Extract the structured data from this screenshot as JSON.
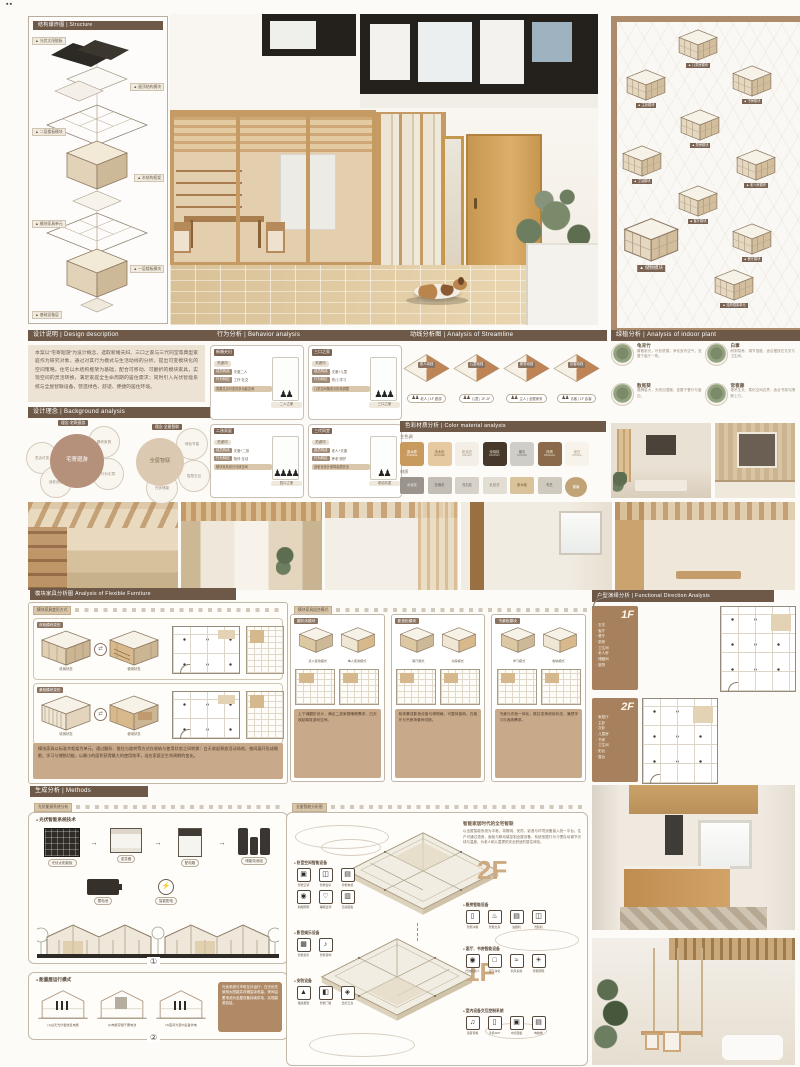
{
  "meta": {
    "corner_marks": "▪▪"
  },
  "headers": {
    "structure": "结构爆炸图 | Structure",
    "design": "设计说明 | Design description",
    "concept": "设计理念 | Background analysis",
    "behavior": "行为分析 | Behavior analysis",
    "circulation": "动线分析图 | Analysis of Streamline",
    "colors": "色彩材质分析 | Color material analysis",
    "plants": "绿植分析 | Analysis of indoor plant",
    "furniture": "模块家具分析图 Analysis of Flexible Furniture",
    "plans": "户型演绎分析 | Functional Direction Analysis",
    "methods": "生成分析 | Methods"
  },
  "structure": {
    "tags": [
      "▲ 光伏太阳能板",
      "▲ 屋顶结构模块",
      "▲ 二层楼板模块",
      "▲ 木结构框架",
      "▲ 模块家具单元",
      "▲ 一层楼板模块",
      "▲ 基础设备层"
    ]
  },
  "modules": {
    "tags": [
      "▲ 儿童房模块",
      "▲ 书房模块",
      "▲ 主卧模块",
      "▲ 厨房模块",
      "▲ 卫浴模块",
      "▲ 老人房模块",
      "▲ 客厅模块",
      "▲ 餐厅模块",
      "▲ 储物模块",
      "▲ 结构框架单元"
    ]
  },
  "design": {
    "body": "本案以“宅寄廻游”为设计概念，选取新婚夫妇、三口之家与三代同堂等典型家庭作为研究对象，通过对其行为模式与生活动线的分析，提出可变模块化的空间策略。住宅以木结构框架为基础，配合可移动、可翻折的模块家具，实现空间的灵活转换，满足家庭全生命周期的居住需求；同时引入光伏智能系统与全屋智联设备，营造绿色、舒适、便捷的居住环境。"
  },
  "concept": {
    "v1": {
      "tag": "理念·宅寄廻游",
      "center": "宅寄廻游",
      "s": [
        "灵活可变",
        "适老适幼",
        "模块家具",
        "行为引导"
      ]
    },
    "v2": {
      "tag": "理念·全屋智联",
      "center": "全屋智联",
      "s": [
        "绿色节能",
        "智慧交互",
        "光伏储能"
      ]
    }
  },
  "behavior": {
    "cards": [
      {
        "tag": "新婚夫妇",
        "kw": "关键词",
        "k1": "成员构成",
        "v1": "夫妻二人",
        "k2": "行为特征",
        "v2": "工作·社交",
        "note": "需要灵活可变的多功能空间",
        "figs": "♟♟",
        "cap": "二人之家"
      },
      {
        "tag": "三口之家",
        "kw": "关键词",
        "k1": "成员构成",
        "v1": "夫妻+儿童",
        "k2": "行为特征",
        "v2": "育儿·学习",
        "note": "儿童空间随成长阶段调整",
        "figs": "♟♟♟",
        "cap": "三口之家"
      },
      {
        "tag": "二孩家庭",
        "kw": "关键词",
        "k1": "成员构成",
        "v1": "夫妻+二孩",
        "k2": "行为特征",
        "v2": "陪伴·互动",
        "note": "模块家具划分兄妹空间",
        "figs": "♟♟♟♟",
        "cap": "四口之家"
      },
      {
        "tag": "三代同堂",
        "kw": "关键词",
        "k1": "成员构成",
        "v1": "老人+夫妻",
        "k2": "行为特征",
        "v2": "养老·照护",
        "note": "适老化设计保障起居安全",
        "figs": "♟♟",
        "cap": "老幼共居"
      }
    ]
  },
  "circulation": {
    "icon": "♟♟",
    "items": [
      {
        "tag": "老人动线",
        "cap": "老人 | 1F 廻游"
      },
      {
        "tag": "儿童动线",
        "cap": "儿童 | 1F-2F"
      },
      {
        "tag": "家务动线",
        "cap": "主人 | 全屋家务"
      },
      {
        "tag": "访客动线",
        "cap": "访客 | 1F 会客"
      }
    ]
  },
  "colors": {
    "g1": "主色调",
    "g2": "材质",
    "row1": [
      {
        "n": "原木棕",
        "h": "#c99a5e",
        "t": "#ffffff"
      },
      {
        "n": "浅木色",
        "h": "#e5c9a0",
        "t": "#7a5f3d"
      },
      {
        "n": "奶油白",
        "h": "#f4efe6",
        "t": "#9a8a72"
      },
      {
        "n": "深胡桃",
        "h": "#46392c",
        "t": "#e8dcc9"
      },
      {
        "n": "暖灰",
        "h": "#cfcdc8",
        "t": "#6b655c"
      },
      {
        "n": "棕褐",
        "h": "#8a6a4a",
        "t": "#f2e6d4"
      },
      {
        "n": "米白",
        "h": "#f7f3ea",
        "t": "#9a8a72"
      }
    ],
    "row2": [
      {
        "n": "水泥灰",
        "h": "#9a948c",
        "t": "#f2efe9"
      },
      {
        "n": "亚麻灰",
        "h": "#c2beb6",
        "t": "#5f594f"
      },
      {
        "n": "浅石纹",
        "h": "#d6d2ca",
        "t": "#6b655c"
      },
      {
        "n": "乳胶漆",
        "h": "#e2ded3",
        "t": "#8a8274"
      },
      {
        "n": "原木板",
        "h": "#d9c39a",
        "t": "#705a3c"
      },
      {
        "n": "布艺",
        "h": "#cfcabe",
        "t": "#645c4e"
      },
      {
        "n": "藤编",
        "h": "#c2a277",
        "t": "#ffffff"
      }
    ]
  },
  "plants": {
    "items": [
      {
        "name": "龟背竹",
        "desc": "喜散射光，叶形舒展，净化室内空气，宜置于客厅一角。"
      },
      {
        "name": "白掌",
        "desc": "耐阴易养，调节湿度，适合摆放在玄关与卫生间。"
      },
      {
        "name": "散尾葵",
        "desc": "蒸腾量大，天然加湿器，宜置于餐厅与窗边。"
      },
      {
        "name": "常春藤",
        "desc": "垂吊生长，柔化空间边界，适合书架与隔断上方。"
      }
    ]
  },
  "furniture": {
    "ruler": "模块家具变形方式",
    "ruler2": "模块家具组合模式",
    "swap": "⇄",
    "rows": [
      {
        "tag": "床柜模块变形",
        "s1": "收纳状态",
        "s2": "使用状态"
      },
      {
        "tag": "桌柜模块变形",
        "s1": "收纳状态",
        "s2": "使用状态"
      }
    ],
    "note": "模块家具以标准木框架为单元，通过翻折、推拉与旋转等方式在收纳与使用状态之间转换：白天收起释放活动场地，夜间展开形成睡眠、学习与储物功能，以最小的面积获得最大的使用效率，适应家庭全生命周期的变化。",
    "cards": [
      {
        "tag": "翻折床模块",
        "l1": "双人使用模式",
        "l2": "单人使用模式",
        "note": "上下铺翻折设计，满足二孩家庭睡眠需求，白天收起释放游戏空间。"
      },
      {
        "tag": "影音柜模块",
        "l1": "客厅模式",
        "l2": "书房模式",
        "note": "柜体集成影音设备与储物格，可整体旋转，在客厅与书房场景间切换。"
      },
      {
        "tag": "书桌柜模块",
        "l1": "学习模式",
        "l2": "收纳模式",
        "note": "书桌与衣柜一体化，推拉变换使用状态，兼顾学习与收纳需求。"
      }
    ]
  },
  "plans": {
    "f1": {
      "label": "1F",
      "rooms": [
        "玄关",
        "客厅",
        "餐厅",
        "厨房",
        "卫生间",
        "老人房",
        "储藏间",
        "庭院"
      ]
    },
    "f2": {
      "label": "2F",
      "rooms": [
        "家庭厅",
        "主卧",
        "次卧",
        "儿童房",
        "书房",
        "卫生间",
        "阳台",
        "露台"
      ]
    }
  },
  "methods": {
    "sub1": "光伏能源系统分析",
    "sub2": "全屋智能分析图",
    "card1": {
      "title": "光伏智能系统技术",
      "flow": [
        "光伏太阳能板",
        "逆变器",
        "配电箱",
        "储能电池组"
      ],
      "b1": "蓄电池",
      "b2": "智能配电",
      "num": "①"
    },
    "card2": {
      "title": "能量屋运行模式",
      "houses": [
        {
          "cap": "(1)白天光伏板收集电能"
        },
        {
          "cap": "(2)电能存储于蓄电池"
        },
        {
          "cap": "(3)夜间为室内设备供电"
        }
      ],
      "note": "光伏系统与市电互补运行：白天优先使用太阳能并存储富余电量，夜间由蓄电池为全屋设备持续供电，实现能源自给。",
      "num": "②"
    }
  },
  "smarthome": {
    "title": "智能家居时代的全宅智联",
    "para": "以全屋智能系统为中枢，将照明、安防、影音与环境设备接入统一平台。住户可通过语音、面板与移动端控制全屋设备，系统依据行为习惯自动调节光线与温度，为老人和儿童提供安全舒适的居住体验。",
    "f2": "2F",
    "f1": "1F",
    "groups": {
      "bedroom": {
        "title": "卧室空间智能设备",
        "icons": [
          {
            "g": "▣",
            "label": "智能空调"
          },
          {
            "g": "◫",
            "label": "智能窗帘"
          },
          {
            "g": "▤",
            "label": "智能电视"
          },
          {
            "g": "◉",
            "label": "助眠照明"
          },
          {
            "g": "♡",
            "label": "睡眠监测"
          },
          {
            "g": "▥",
            "label": "温感面板"
          }
        ]
      },
      "av": {
        "title": "影音娱乐设备",
        "icons": [
          {
            "g": "▦",
            "label": "智能投影"
          },
          {
            "g": "♪",
            "label": "智能音响"
          }
        ]
      },
      "security": {
        "title": "安防设备",
        "icons": [
          {
            "g": "▲",
            "label": "烟感报警"
          },
          {
            "g": "◧",
            "label": "智能门锁"
          },
          {
            "g": "◈",
            "label": "监控云台"
          }
        ]
      },
      "kitchen": {
        "title": "厨房智能设备",
        "icons": [
          {
            "g": "▯",
            "label": "智能冰箱"
          },
          {
            "g": "♨",
            "label": "智能灶具"
          },
          {
            "g": "▤",
            "label": "油烟机"
          },
          {
            "g": "◫",
            "label": "洗碗机"
          }
        ]
      },
      "living": {
        "title": "客厅、书房智能设备",
        "icons": [
          {
            "g": "◉",
            "label": "扫地机器人"
          },
          {
            "g": "□",
            "label": "空气净化"
          },
          {
            "g": "≈",
            "label": "新风系统"
          },
          {
            "g": "☀",
            "label": "智能照明"
          }
        ]
      },
      "control": {
        "title": "室内设备交互控制系统",
        "icons": [
          {
            "g": "♫",
            "label": "语音音箱"
          },
          {
            "g": "▯",
            "label": "手机APP"
          },
          {
            "g": "▣",
            "label": "中控面板"
          },
          {
            "g": "▤",
            "label": "电脑端"
          }
        ]
      }
    }
  }
}
